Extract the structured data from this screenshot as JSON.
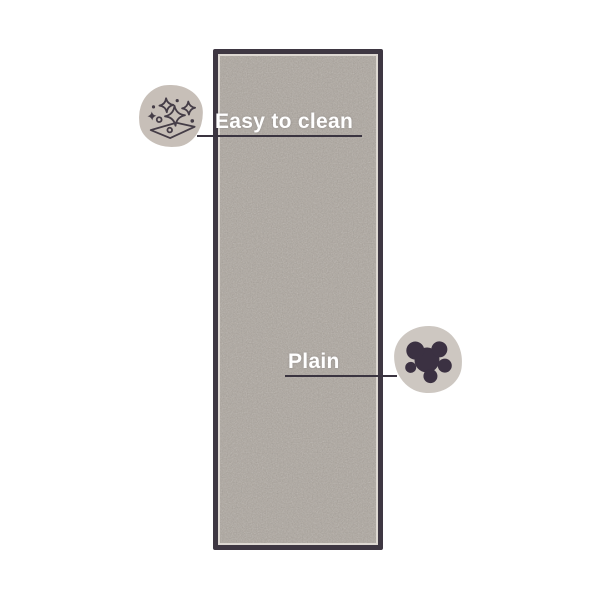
{
  "scene": {
    "background": "#ffffff",
    "subject": "runner rug product photo with feature callouts"
  },
  "callouts": [
    {
      "label": "Easy to clean",
      "icon": "sparkle-clean-icon"
    },
    {
      "label": "Plain",
      "icon": "stain-splat-icon"
    }
  ],
  "theme": {
    "bg": "#ffffff",
    "rug_border": "#3e3742",
    "rug_edge": "#ddd8d2",
    "rug_pile": "#ada69e",
    "badge_top": "#c7bfb8",
    "badge_bottom": "#cdc7c1",
    "icon_dark": "#453d47",
    "splat": "#3b3142",
    "label_text": "#ffffff",
    "leader_line": "#3a3440"
  }
}
